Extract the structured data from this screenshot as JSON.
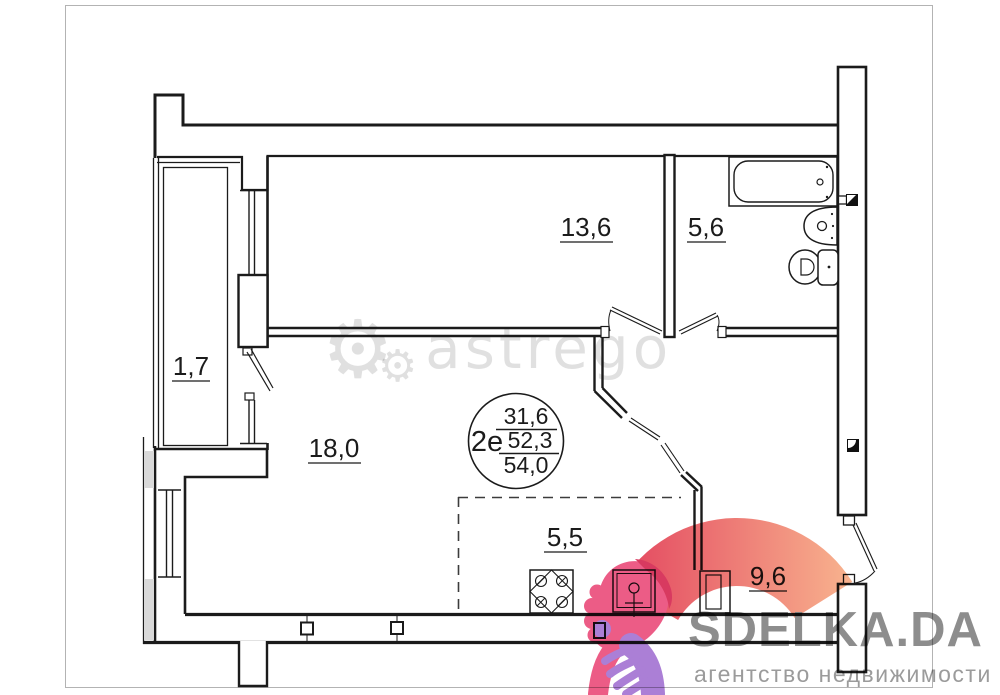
{
  "floor_plan": {
    "rooms": [
      {
        "name": "balcony",
        "area": "1,7"
      },
      {
        "name": "room",
        "area": "13,6"
      },
      {
        "name": "bathroom",
        "area": "5,6"
      },
      {
        "name": "living-room",
        "area": "18,0"
      },
      {
        "name": "kitchen",
        "area": "5,5"
      },
      {
        "name": "hallway",
        "area": "9,6"
      }
    ],
    "summary": {
      "type": "2е",
      "living_area": "31,6",
      "middle_area": "52,3",
      "total_area": "54,0"
    },
    "fixtures": [
      "bathtub-icon",
      "washbasin-icon",
      "toilet-icon",
      "stove-icon",
      "kitchen-sink-icon"
    ]
  },
  "watermark": {
    "gear_icon": "⚙",
    "text": "astrego"
  },
  "branding": {
    "name": "SDELKA.DA",
    "tagline": "агентство недвижимости",
    "colors": {
      "arc_start": "#e3465f",
      "arc_end": "#f8b38e",
      "hand_pink": "#ec5c86",
      "hand_red": "#d83a60",
      "hand_purple": "#ab7fd6",
      "text_gray": "#8d8d8d",
      "tagline_gray": "#9b9b9b"
    }
  }
}
